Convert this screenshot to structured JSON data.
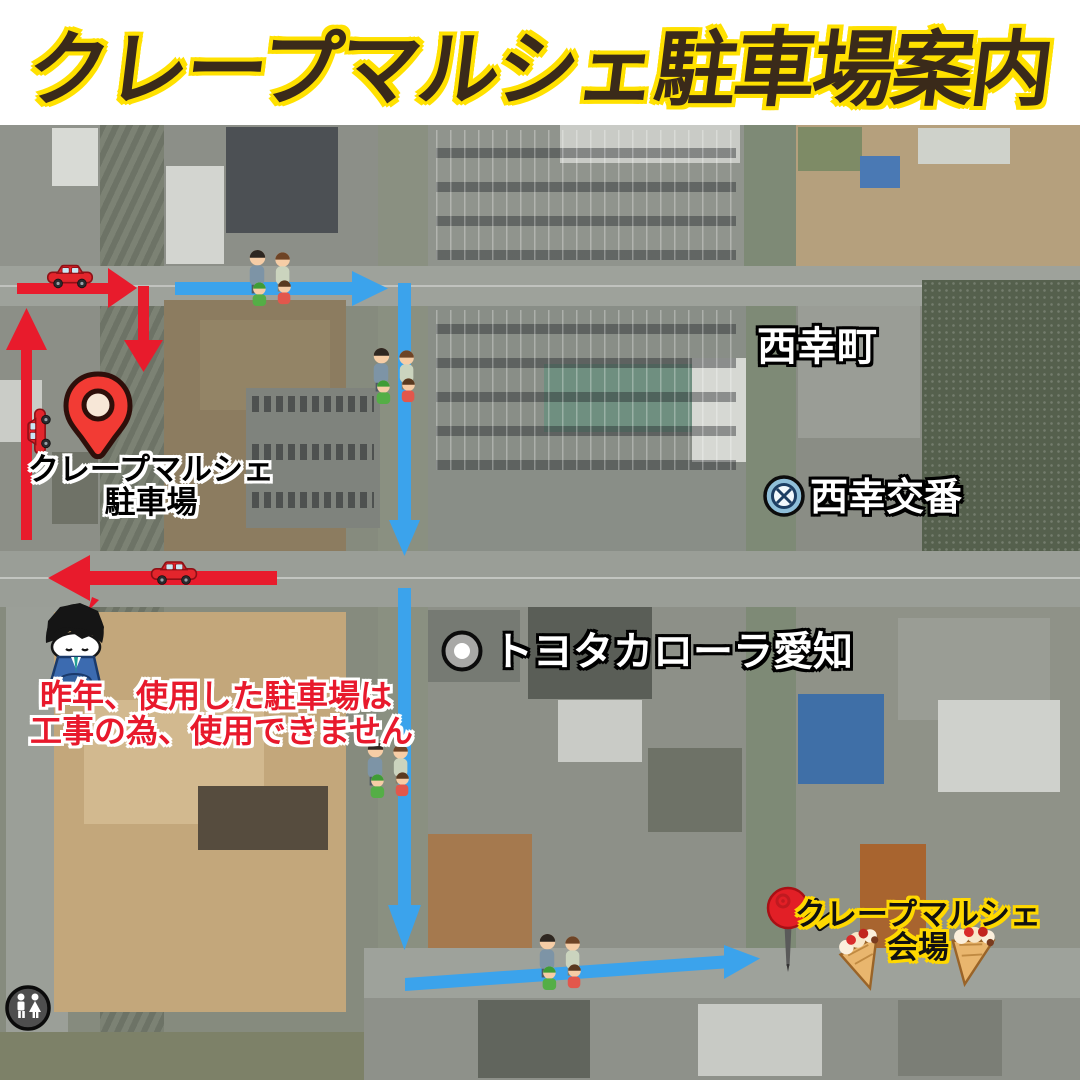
{
  "title": "クレープマルシェ駐車場案内",
  "map": {
    "parking_pin_label": {
      "line1": "クレープマルシェ",
      "line2": "駐車場"
    },
    "warning": {
      "line1": "昨年、使用した駐車場は",
      "line2": "工事の為、使用できません"
    },
    "place_labels": {
      "district": "西幸町",
      "police_box": "西幸交番",
      "car_dealer": "トヨタカローラ愛知"
    },
    "venue_label": {
      "line1": "クレープマルシェ",
      "line2": "会場"
    }
  },
  "colors": {
    "header_bg": "#FFFFFF",
    "title_text": "#3A2A1A",
    "title_outline": "#FFE100",
    "car_route": "#E81B2C",
    "walk_route": "#3BA3EC",
    "warning_text": "#E8192C",
    "parking_label_text": "#000000",
    "parking_label_outline": "#FFFFFF",
    "venue_label_text": "#111111",
    "venue_label_outline": "#FFD800",
    "map_label_text": "#FFFFFF",
    "map_label_outline": "#000000"
  },
  "icons": {
    "parking_pin": "map-pin-icon",
    "venue_pin": "pushpin-icon",
    "cars": "red-car-icon",
    "families": "walking-family-icon",
    "apology": "bowing-man-icon",
    "police_box": "police-station-icon",
    "car_dealer": "poi-dot-icon",
    "restroom": "restroom-icon",
    "crepes": "crepe-icon"
  }
}
